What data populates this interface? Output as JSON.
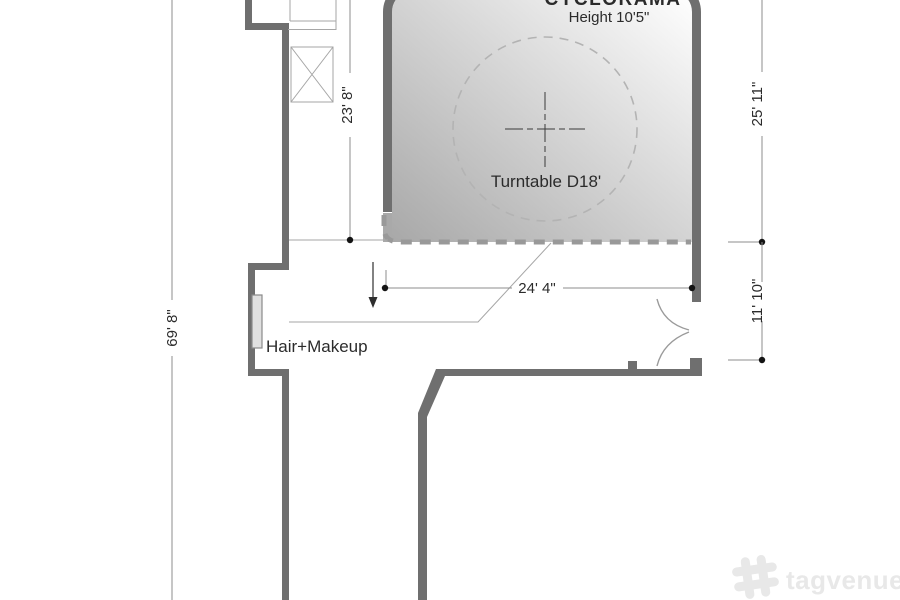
{
  "floor_plan": {
    "areas": {
      "cyclorama": {
        "title": "CYCLORAMA",
        "height_label": "Height 10'5\""
      },
      "turntable": {
        "label": "Turntable D18'"
      },
      "hair_makeup": {
        "label": "Hair+Makeup"
      }
    },
    "dimensions": {
      "overall_height": "69' 8\"",
      "cyclorama_left_depth": "23' 8\"",
      "cyclorama_right_depth": "25' 11\"",
      "entrance_wall": "11' 10\"",
      "floor_width": "24' 4\""
    }
  },
  "watermark": {
    "brand": "tagvenue"
  },
  "colors": {
    "wall": "#6f6f6f",
    "cyc_fill_dark": "#a8a8a8",
    "cyc_fill_light": "#ffffff",
    "cyc_front_dashed_edge": "#999999",
    "turntable_circle": "#b3b3b3",
    "dimension_line": "#8c8c8c",
    "text": "#2b2b2b",
    "watermark": "#e8e8e8"
  }
}
